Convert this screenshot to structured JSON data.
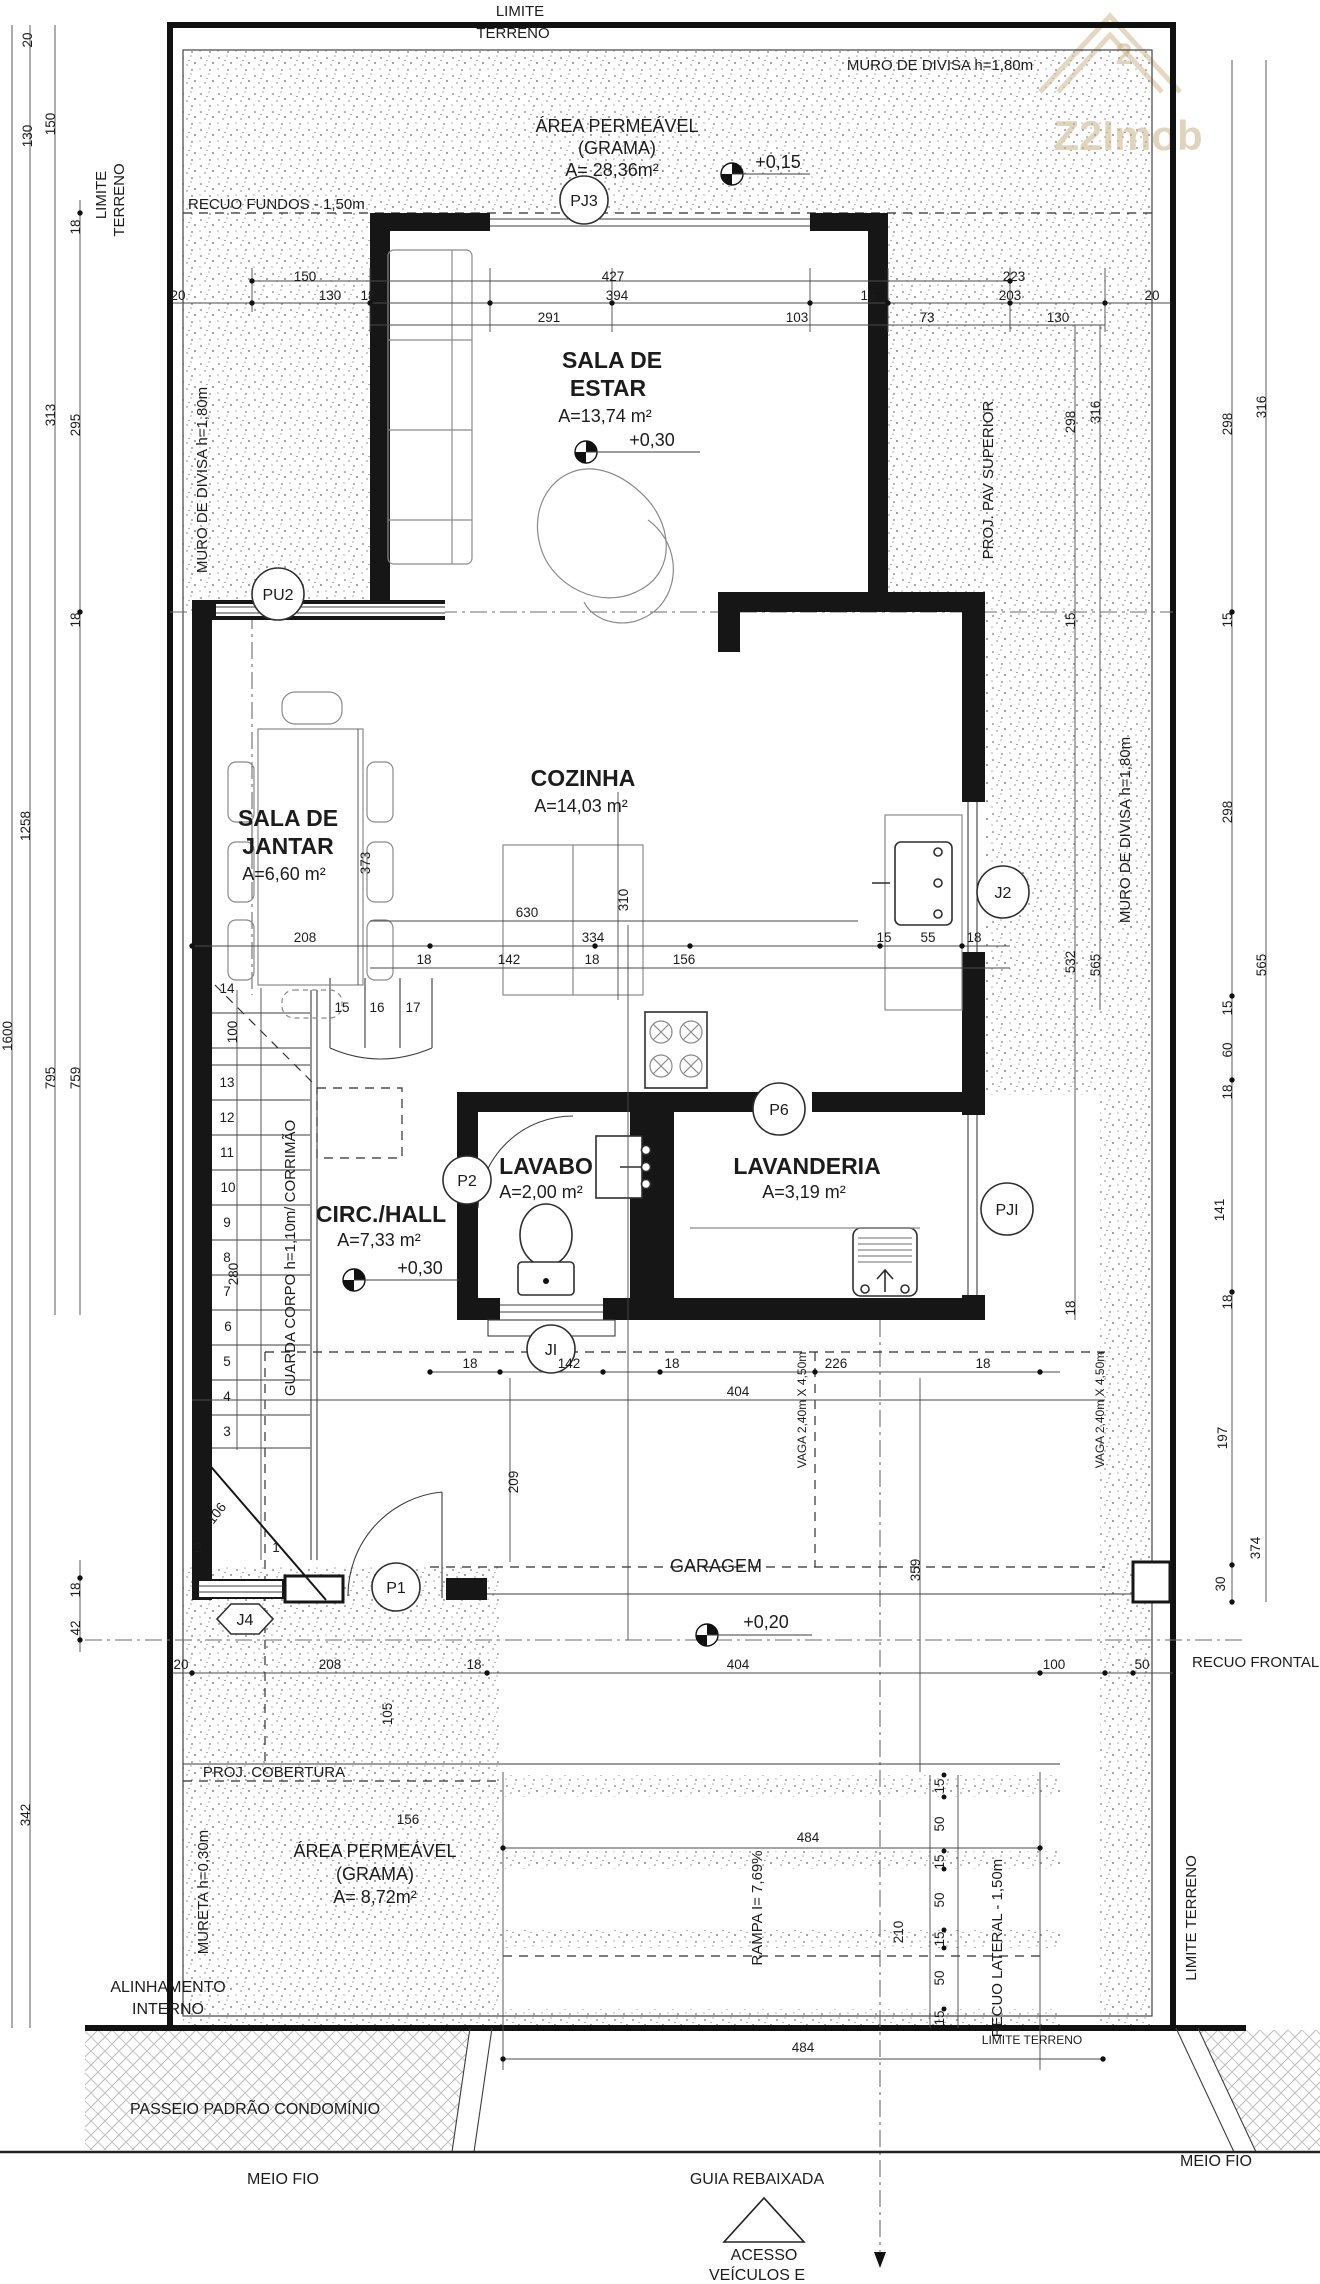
{
  "watermark": {
    "brand": "Z2Imob",
    "sup": "2"
  },
  "boundary": {
    "limite1": "LIMITE",
    "limite2": "TERRENO",
    "limite_left1": "LIMITE",
    "limite_left2": "TERRENO",
    "muro_top": "MURO DE DIVISA h=1,80m",
    "muro_left": "MURO DE DIVISA h=1,80m",
    "muro_right": "MURO DE DIVISA h=1,80m",
    "limite_bottom": "LIMITE TERRENO",
    "limite_right_v": "LIMITE TERRENO"
  },
  "setbacks": {
    "recuo_fundos": "RECUO FUNDOS - 1,50m",
    "recuo_frontal": "RECUO FRONTAL -",
    "recuo_lateral": "RECUO LATERAL - 1,50m",
    "alinhamento1": "ALINHAMENTO",
    "alinhamento2": "INTERNO"
  },
  "rooms": {
    "estar": {
      "l1": "SALA DE",
      "l2": "ESTAR",
      "area": "A=13,74 m²",
      "level": "+0,30"
    },
    "jantar": {
      "l1": "SALA DE",
      "l2": "JANTAR",
      "area": "A=6,60 m²"
    },
    "cozinha": {
      "l1": "COZINHA",
      "area": "A=14,03 m²"
    },
    "hall": {
      "l1": "CIRC./HALL",
      "area": "A=7,33 m²",
      "level": "+0,30"
    },
    "lavabo": {
      "l1": "LAVABO",
      "area": "A=2,00 m²"
    },
    "lavanderia": {
      "l1": "LAVANDERIA",
      "area": "A=3,19 m²"
    },
    "garagem": {
      "l1": "GARAGEM",
      "level": "+0,20"
    },
    "grama_top": {
      "l1": "ÁREA PERMEÁVEL",
      "l2": "(GRAMA)",
      "area": "A= 28,36m²",
      "level": "+0,15"
    },
    "grama_bottom": {
      "l1": "ÁREA PERMEÁVEL",
      "l2": "(GRAMA)",
      "area": "A= 8,72m²"
    }
  },
  "site": {
    "proj_pav": "PROJ. PAV SUPERIOR",
    "proj_cobertura": "PROJ. COBERTURA",
    "mureta": "MURETA h=0,30m",
    "rampa": "RAMPA I= 7,69%",
    "guarda_corpo": "GUARDA CORPO h=1,10m/ CORRIMÃO",
    "vaga": "VAGA 2,40m X 4,50m",
    "passeio": "PASSEIO PADRÃO CONDOMÍNIO",
    "meio_fio": "MEIO FIO",
    "guia": "GUIA REBAIXADA",
    "acesso1": "ACESSO",
    "acesso2": "VEÍCULOS E"
  },
  "tags": {
    "pj3": "PJ3",
    "pu2": "PU2",
    "j2": "J2",
    "p6": "P6",
    "p2": "P2",
    "pji": "PJI",
    "ji": "JI",
    "p1": "P1",
    "j4": "J4"
  },
  "dims": {
    "top1": [
      "150",
      "427",
      "223"
    ],
    "top2": [
      "20",
      "130",
      "18",
      "394",
      "15",
      "203",
      "20"
    ],
    "top3": [
      "291",
      "103",
      "73",
      "130"
    ],
    "leftv": [
      "20",
      "150",
      "130",
      "18",
      "313",
      "295",
      "18",
      "1258",
      "1600",
      "795",
      "759",
      "100",
      "280",
      "18",
      "42",
      "342"
    ],
    "rightv": [
      "298",
      "316",
      "15",
      "15",
      "298",
      "316",
      "298",
      "532",
      "565",
      "565",
      "15",
      "60",
      "18",
      "18",
      "141",
      "18",
      "197",
      "374",
      "30"
    ],
    "midh": [
      "630",
      "334",
      "208",
      "15",
      "55",
      "18",
      "18",
      "142",
      "18",
      "156"
    ],
    "midv": [
      "310",
      "373"
    ],
    "garage": [
      "18",
      "142",
      "18",
      "226",
      "18",
      "404",
      "209",
      "359"
    ],
    "bottomh": [
      "20",
      "208",
      "18",
      "404",
      "100",
      "50",
      "156",
      "484",
      "484"
    ],
    "bottomv": [
      "105",
      "210"
    ],
    "rampcol": [
      "15",
      "50",
      "15",
      "50",
      "15",
      "50",
      "15"
    ],
    "stairs": [
      "14",
      "13",
      "12",
      "11",
      "10",
      "9",
      "8",
      "7",
      "6",
      "5",
      "4",
      "3",
      "15",
      "16",
      "17",
      "2",
      "1",
      "106"
    ]
  }
}
